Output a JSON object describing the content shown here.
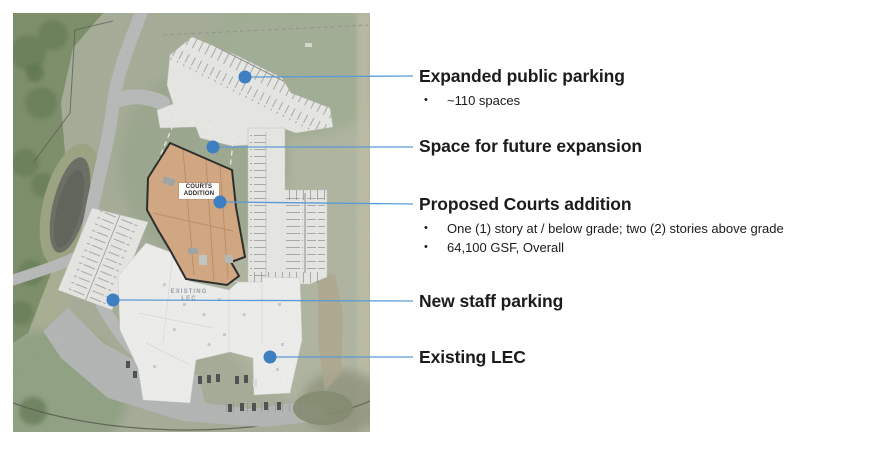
{
  "callouts": [
    {
      "title": "Expanded public parking",
      "bullets": [
        "~110 spaces"
      ]
    },
    {
      "title": "Space for future expansion",
      "bullets": []
    },
    {
      "title": "Proposed Courts addition",
      "bullets": [
        "One (1) story at / below grade; two (2) stories above grade",
        "64,100 GSF, Overall"
      ]
    },
    {
      "title": "New staff parking",
      "bullets": []
    },
    {
      "title": "Existing LEC",
      "bullets": []
    }
  ],
  "map": {
    "courts_addition_label": "COURTS ADDITION",
    "existing_lec_label": "EXISTING LEC"
  },
  "bullet_glyph": "•",
  "colors": {
    "leader_line": "#5b9bd5",
    "leader_dot": "#3e7fc1",
    "courts_fill": "#dca87e",
    "title_text": "#1b1b1b",
    "map_label_lec": "#94a0ac"
  }
}
